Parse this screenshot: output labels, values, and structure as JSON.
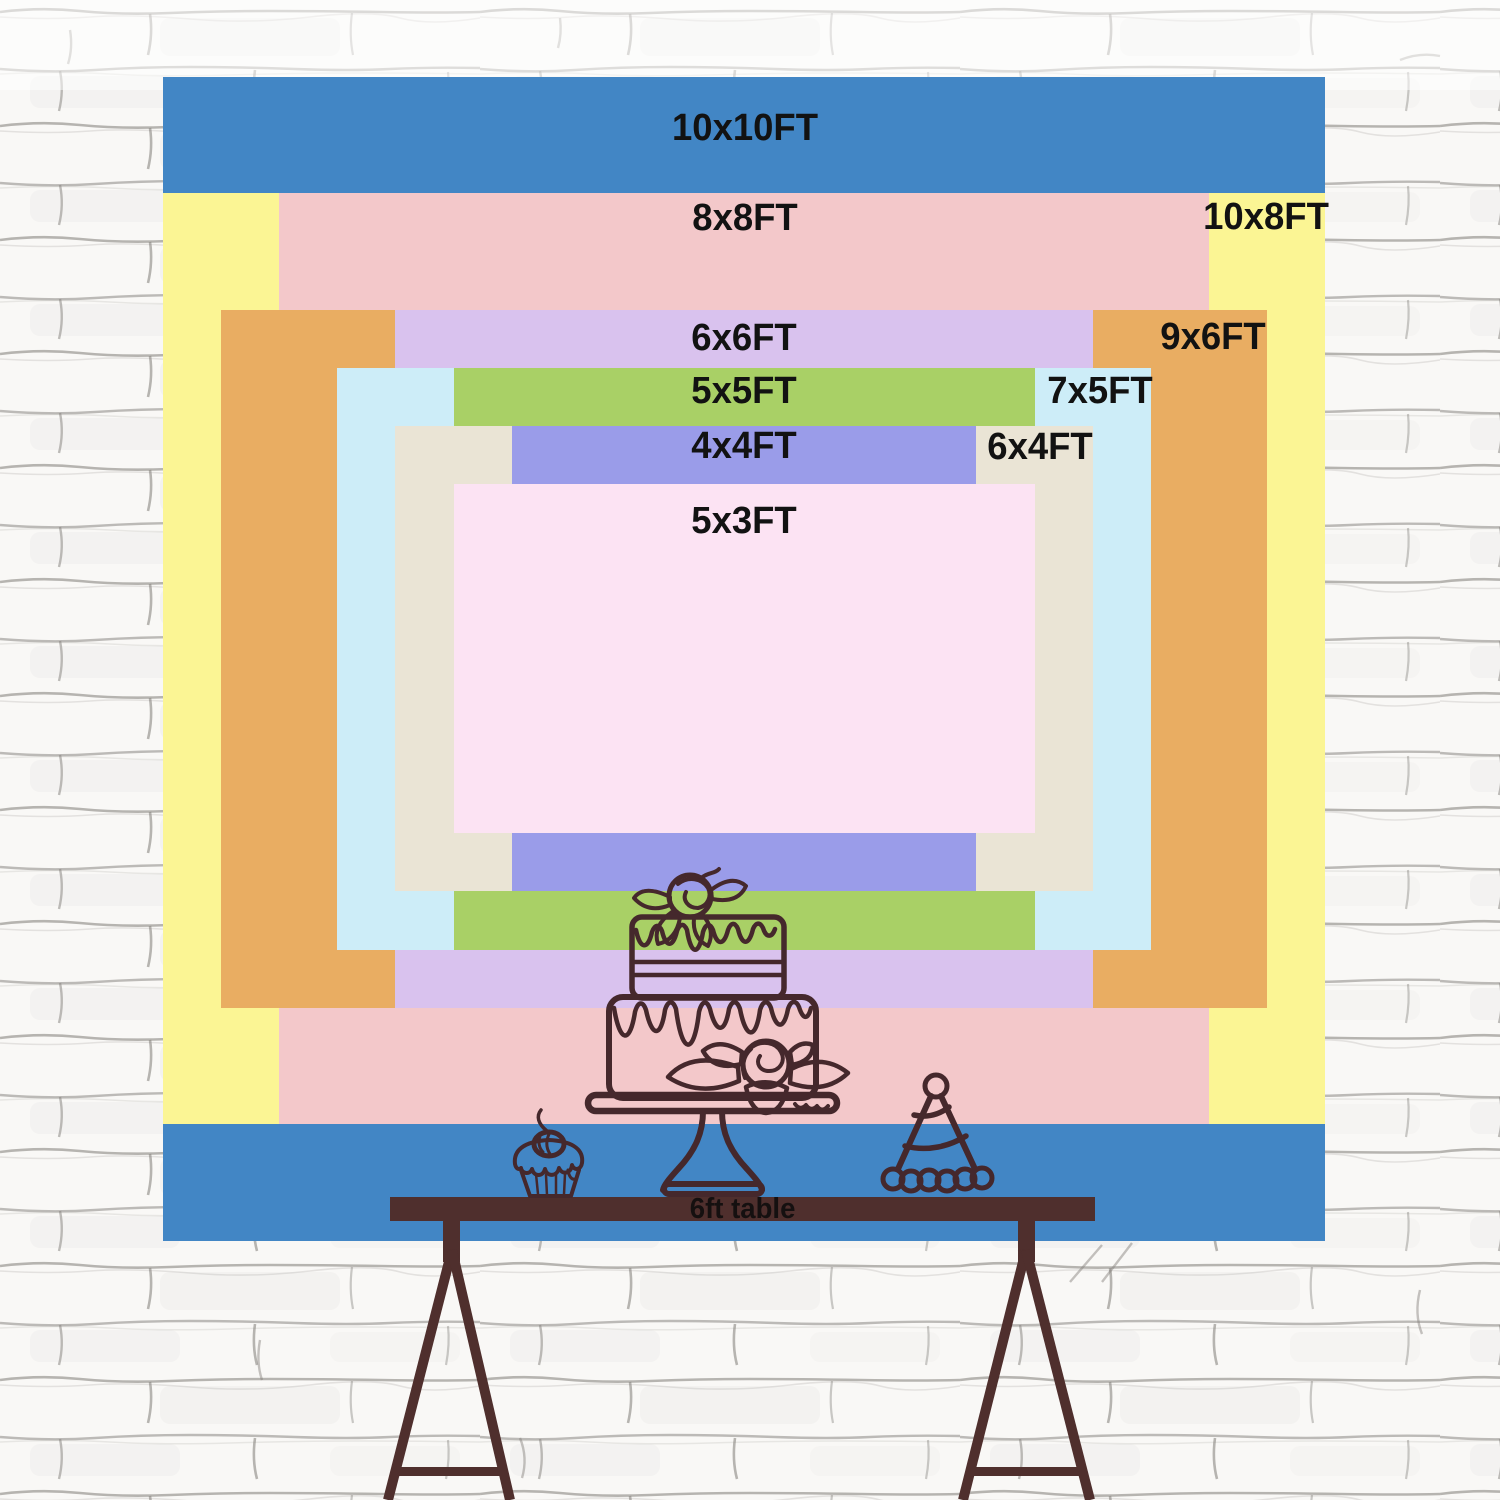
{
  "backdrop_sizes": {
    "unit": "FT",
    "px_per_ft_x": 116.2,
    "px_per_ft_y": 116.35,
    "origin": {
      "x": 163,
      "y": 77
    },
    "outer": {
      "w_ft": 10,
      "h_ft": 10
    },
    "layers": [
      {
        "name": "10x10",
        "label": "10x10FT",
        "color": "#4286c5",
        "w_ft": 10,
        "h_ft": 10,
        "label_pos": {
          "x": 745,
          "y": 128
        }
      },
      {
        "name": "10x8",
        "label": "10x8FT",
        "color": "#fbf594",
        "w_ft": 10,
        "h_ft": 8,
        "label_pos": {
          "x": 1266,
          "y": 217
        }
      },
      {
        "name": "8x8",
        "label": "8x8FT",
        "color": "#f3c8ca",
        "w_ft": 8,
        "h_ft": 8,
        "label_pos": {
          "x": 745,
          "y": 218
        }
      },
      {
        "name": "9x6",
        "label": "9x6FT",
        "color": "#e9ad62",
        "w_ft": 9,
        "h_ft": 6,
        "label_pos": {
          "x": 1213,
          "y": 337
        }
      },
      {
        "name": "6x6",
        "label": "6x6FT",
        "color": "#d9c2ee",
        "w_ft": 6,
        "h_ft": 6,
        "label_pos": {
          "x": 744,
          "y": 338
        }
      },
      {
        "name": "7x5",
        "label": "7x5FT",
        "color": "#cdedf8",
        "w_ft": 7,
        "h_ft": 5,
        "label_pos": {
          "x": 1100,
          "y": 391
        }
      },
      {
        "name": "5x5",
        "label": "5x5FT",
        "color": "#a9d066",
        "w_ft": 5,
        "h_ft": 5,
        "label_pos": {
          "x": 744,
          "y": 391
        }
      },
      {
        "name": "6x4",
        "label": "6x4FT",
        "color": "#eae4d5",
        "w_ft": 6,
        "h_ft": 4,
        "label_pos": {
          "x": 1040,
          "y": 447
        }
      },
      {
        "name": "4x4",
        "label": "4x4FT",
        "color": "#9a9ce9",
        "w_ft": 4,
        "h_ft": 4,
        "label_pos": {
          "x": 744,
          "y": 446
        }
      },
      {
        "name": "5x3",
        "label": "5x3FT",
        "color": "#fce3f3",
        "w_ft": 5,
        "h_ft": 3,
        "label_pos": {
          "x": 744,
          "y": 521
        }
      }
    ]
  },
  "chart_data": {
    "type": "table",
    "title": "Backdrop size comparison (nested rectangles, feet)",
    "columns": [
      "label",
      "width_ft",
      "height_ft"
    ],
    "rows": [
      [
        "10x10FT",
        10,
        10
      ],
      [
        "10x8FT",
        10,
        8
      ],
      [
        "8x8FT",
        8,
        8
      ],
      [
        "9x6FT",
        9,
        6
      ],
      [
        "6x6FT",
        6,
        6
      ],
      [
        "7x5FT",
        7,
        5
      ],
      [
        "5x5FT",
        5,
        5
      ],
      [
        "6x4FT",
        6,
        4
      ],
      [
        "4x4FT",
        4,
        4
      ],
      [
        "5x3FT",
        5,
        3
      ]
    ]
  },
  "table": {
    "label": "6ft table",
    "color": "#4f2f2d",
    "text_color": "#151010"
  },
  "artwork": {
    "line_color": "#45282c",
    "items": [
      "tiered-cake",
      "cupcake",
      "party-hat"
    ]
  },
  "wall": {
    "base_color": "#f9f8f6",
    "mortar_color": "#807c77"
  }
}
